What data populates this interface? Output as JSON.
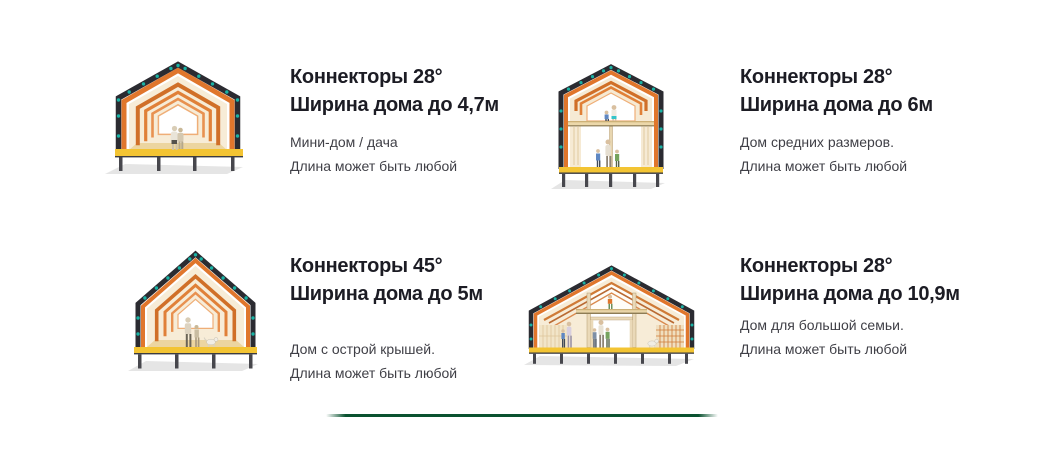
{
  "section": {
    "cards": [
      {
        "title_line1": "Коннекторы 28°",
        "title_line2": "Ширина дома до 4,7м",
        "desc_line1": "Мини-дом / дача",
        "desc_line2": "Длина может быть любой",
        "illustration": "gable-house-28deg-mini-single-story"
      },
      {
        "title_line1": "Коннекторы 28°",
        "title_line2": "Ширина дома до 6м",
        "desc_line1": "Дом средних размеров.",
        "desc_line2": "Длина может быть любой",
        "illustration": "gable-house-28deg-two-story"
      },
      {
        "title_line1": "Коннекторы 45°",
        "title_line2": "Ширина дома до 5м",
        "desc_line1": "Дом с острой крышей.",
        "desc_line2": "Длина может быть любой",
        "illustration": "gable-house-45deg-steep-roof"
      },
      {
        "title_line1": "Коннекторы 28°",
        "title_line2": "Ширина дома до 10,9м",
        "desc_line1": "Дом для большой семьи.",
        "desc_line2": "Длина может быть любой",
        "illustration": "gable-house-28deg-wide-mezzanine"
      }
    ],
    "colors": {
      "title_text": "#1c1c24",
      "body_text": "#3f3f46",
      "divider_green": "#0a5230",
      "frame_dark": "#2b2b31",
      "frame_orange": "#e0762c",
      "connector_teal": "#19b2a4",
      "floor_yellow": "#f3c433",
      "wall_cream": "#f6ead4"
    }
  }
}
